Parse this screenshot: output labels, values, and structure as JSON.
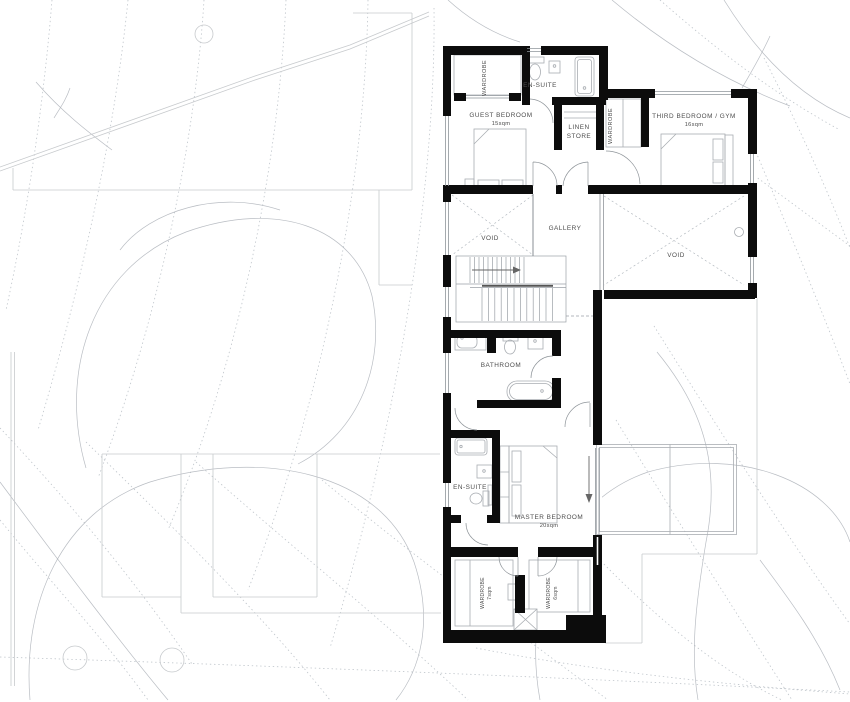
{
  "floor_plan": {
    "rooms": {
      "guest_bedroom": {
        "label": "GUEST BEDROOM",
        "area": "15sqm"
      },
      "third_bedroom": {
        "label": "THIRD BEDROOM / GYM",
        "area": "16sqm"
      },
      "master_bedroom": {
        "label": "MASTER BEDROOM",
        "area": "20sqm"
      },
      "bathroom": {
        "label": "BATHROOM"
      },
      "ensuite_guest": {
        "label": "EN-SUITE"
      },
      "ensuite_master": {
        "label": "EN-SUITE"
      },
      "linen_store": {
        "line1": "LINEN",
        "line2": "STORE"
      },
      "gallery": {
        "label": "GALLERY"
      },
      "void_left": {
        "label": "VOID"
      },
      "void_right": {
        "label": "VOID"
      },
      "wardrobe_guest": {
        "label": "WARDROBE"
      },
      "wardrobe_third": {
        "label": "WARDROBE"
      },
      "wardrobe_master_left": {
        "label": "WARDROBE",
        "area": "7sqm"
      },
      "wardrobe_master_right": {
        "label": "WARDROBE",
        "area": "6sqm"
      }
    },
    "colors": {
      "wall": "#0c0c0c",
      "fixture": "#a9adb2",
      "opening": "#8f959a",
      "contour": "#b3bac1",
      "canopy": "#adb2b8",
      "site": "#c7cacd",
      "text": "#4d4d4d",
      "voidline": "#b4bac0"
    }
  }
}
